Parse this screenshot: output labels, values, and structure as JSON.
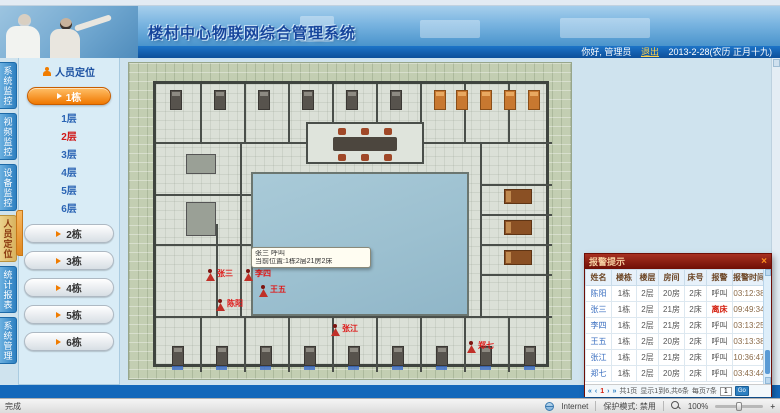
{
  "header": {
    "app_title": "楼村中心物联网综合管理系统",
    "greeting": "你好, 管理员",
    "logout_label": "退出",
    "date_text": "2013-2-28(农历 正月十九)"
  },
  "side_tabs": {
    "items": [
      {
        "label": "系统监控",
        "active": false
      },
      {
        "label": "视频监控",
        "active": false
      },
      {
        "label": "设备监控",
        "active": false
      },
      {
        "label": "人员定位",
        "active": true
      },
      {
        "label": "统计报表",
        "active": false
      },
      {
        "label": "系统管理",
        "active": false
      }
    ]
  },
  "sidebar": {
    "panel_title": "人员定位",
    "active_building_label": "1栋",
    "floors": [
      {
        "label": "1层",
        "active": false
      },
      {
        "label": "2层",
        "active": true
      },
      {
        "label": "3层",
        "active": false
      },
      {
        "label": "4层",
        "active": false
      },
      {
        "label": "5层",
        "active": false
      },
      {
        "label": "6层",
        "active": false
      }
    ],
    "buildings": [
      "2栋",
      "3栋",
      "4栋",
      "5栋",
      "6栋"
    ]
  },
  "floorplan": {
    "tooltip": {
      "line1": "张三 呼叫",
      "line2": "当前位置:1栋2层21房2床"
    },
    "markers": [
      {
        "name": "张三",
        "x": 77,
        "y": 206
      },
      {
        "name": "李四",
        "x": 115,
        "y": 206
      },
      {
        "name": "王五",
        "x": 130,
        "y": 222
      },
      {
        "name": "陈阳",
        "x": 87,
        "y": 236
      },
      {
        "name": "张江",
        "x": 202,
        "y": 261
      },
      {
        "name": "郑七",
        "x": 338,
        "y": 278
      }
    ]
  },
  "alarm_panel": {
    "title": "报警提示",
    "close_label": "×",
    "columns": [
      "姓名",
      "楼栋",
      "楼层",
      "房间",
      "床号",
      "报警",
      "报警时间"
    ],
    "alert_value": "离床",
    "rows": [
      [
        "陈阳",
        "1栋",
        "2层",
        "20房",
        "2床",
        "呼叫",
        "03:12:38"
      ],
      [
        "张三",
        "1栋",
        "2层",
        "21房",
        "2床",
        "离床",
        "09:49:34"
      ],
      [
        "李四",
        "1栋",
        "2层",
        "21房",
        "2床",
        "呼叫",
        "03:13:25"
      ],
      [
        "王五",
        "1栋",
        "2层",
        "20房",
        "2床",
        "呼叫",
        "03:13:38"
      ],
      [
        "张江",
        "1栋",
        "2层",
        "21房",
        "2床",
        "呼叫",
        "10:36:47"
      ],
      [
        "郑七",
        "1栋",
        "2层",
        "20房",
        "2床",
        "呼叫",
        "03:43:44"
      ]
    ],
    "pagination": {
      "first": "«",
      "prev": "‹",
      "page": "1",
      "next": "›",
      "last": "»",
      "page_label": "共1页",
      "info": "显示1到6,共6条",
      "per_page": "每页7条",
      "input_value": "1",
      "go_label": "Go"
    }
  },
  "statusbar": {
    "left_text": "完成",
    "zone_text": "Internet",
    "protected_text": "保护模式: 禁用",
    "zoom_text": "100%",
    "zoom_plus": "+"
  },
  "colors": {
    "accent_orange": "#f07c00",
    "alert_red": "#d42010",
    "header_blue": "#1265b5",
    "popup_red": "#6e0e06"
  }
}
